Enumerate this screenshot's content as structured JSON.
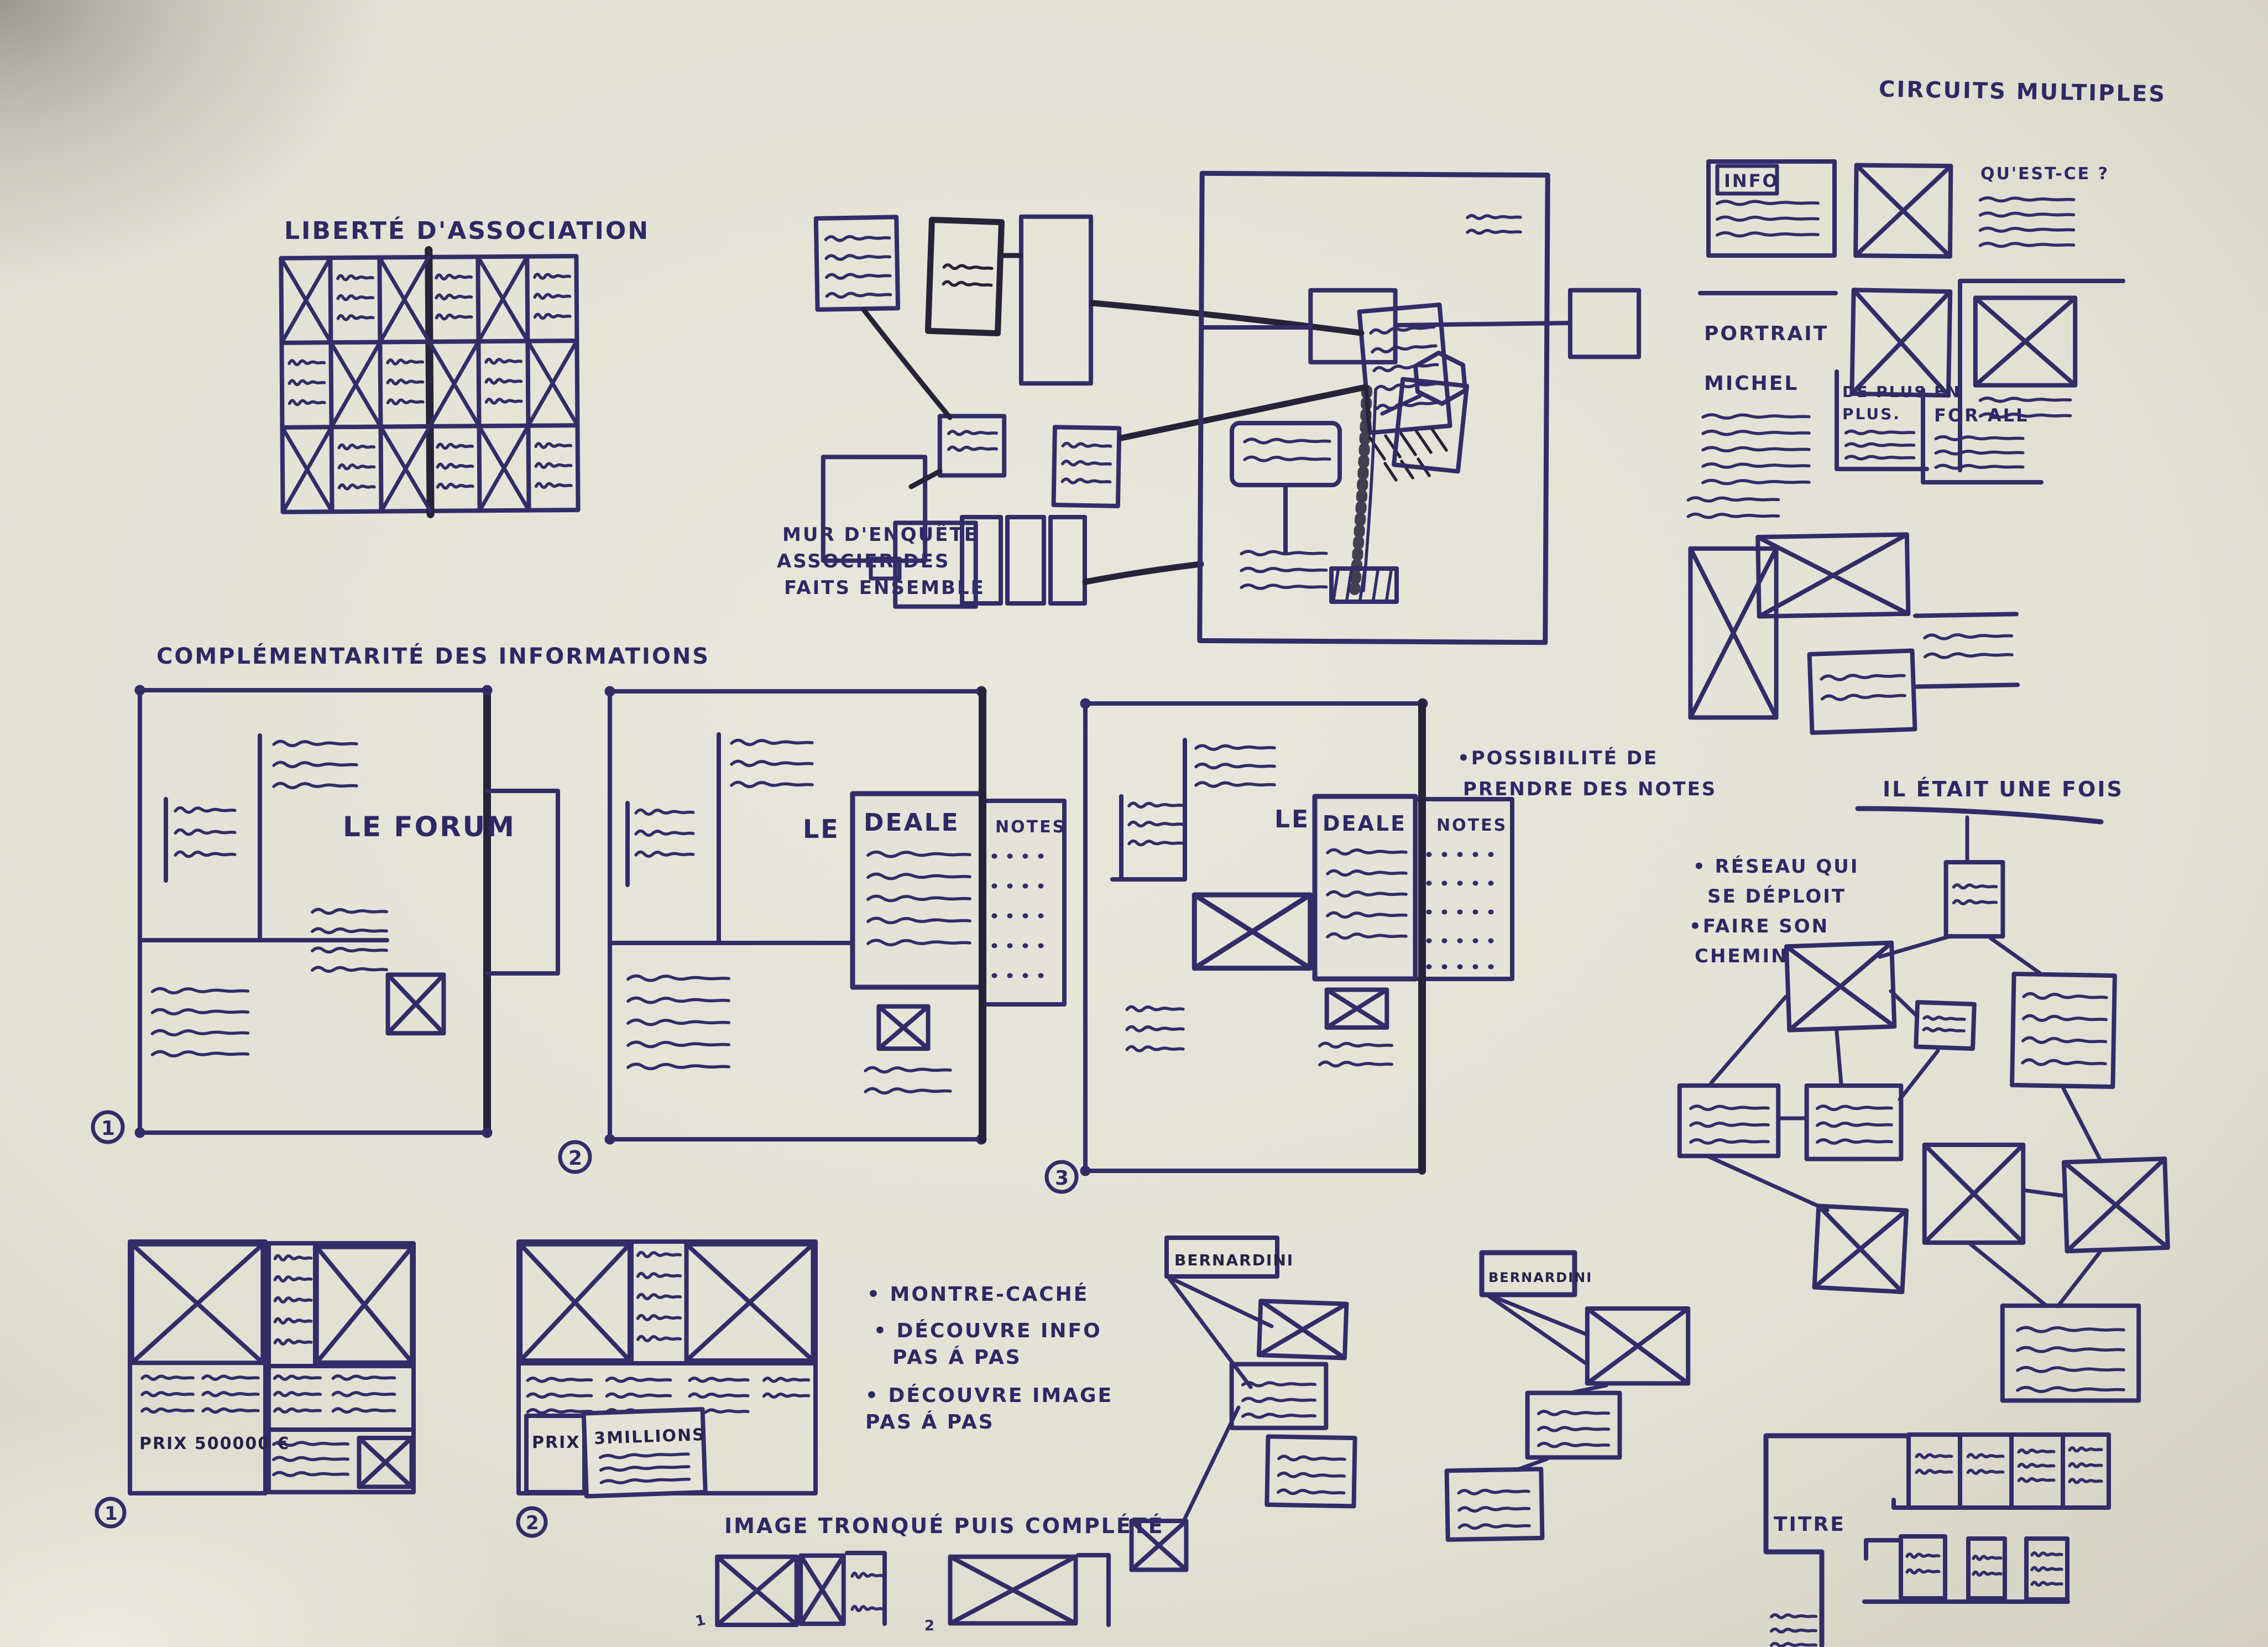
{
  "colors": {
    "ink": "#322c69",
    "ink_dark": "#262239",
    "paper": "#e5e3d7"
  },
  "liberte": {
    "title": "LIBERTÉ D'ASSOCIATION"
  },
  "mur": {
    "line1": "MUR D'ENQUÊTE",
    "line2": "ASSOCIER DES",
    "line3": "FAITS ENSEMBLE"
  },
  "circuits": {
    "title": "CIRCUITS MULTIPLES",
    "info": "INFO",
    "question": "QU'EST-CE ?",
    "portrait1": "PORTRAIT",
    "portrait2": "MICHEL",
    "deplus1": "DE PLUS EN",
    "deplus2": "PLUS.",
    "forall": "FOR ALL"
  },
  "complementarite": {
    "title": "COMPLÉMENTARITÉ DES INFORMATIONS",
    "panel1": {
      "number": "1",
      "title": "LE FORUM"
    },
    "panel2": {
      "number": "2",
      "prefix": "LE",
      "title": "DEALE",
      "notes": "NOTES"
    },
    "panel3": {
      "number": "3",
      "prefix": "LE",
      "title": "DEALE",
      "notes": "NOTES",
      "note_line1": "•POSSIBILITÉ DE",
      "note_line2": "PRENDRE DES NOTES"
    }
  },
  "iletait": {
    "title": "IL ÉTAIT UNE FOIS",
    "ann1": "• RÉSEAU QUI",
    "ann2": "SE DÉPLOIT",
    "ann3": "•FAIRE SON",
    "ann4": "CHEMIN"
  },
  "prix": {
    "thumb1": {
      "number": "1",
      "label": "PRIX 500000 €"
    },
    "thumb2": {
      "number": "2",
      "label_prix": "PRIX",
      "label_amount": "3MILLIONS"
    }
  },
  "montre": {
    "bullet1": "• MONTRE-CACHÉ",
    "bullet2": "• DÉCOUVRE INFO",
    "bullet2b": "PAS Á PAS",
    "bullet3": "• DÉCOUVRE IMAGE",
    "bullet3b": "PAS Á PAS"
  },
  "tronque": {
    "title": "IMAGE TRONQUÉ PUIS COMPLÉTÉ",
    "label1": "1",
    "label2": "2"
  },
  "bernardini": {
    "label1": "BERNARDINI",
    "label2": "BERNARDINI"
  },
  "titre": {
    "label": "TITRE"
  }
}
